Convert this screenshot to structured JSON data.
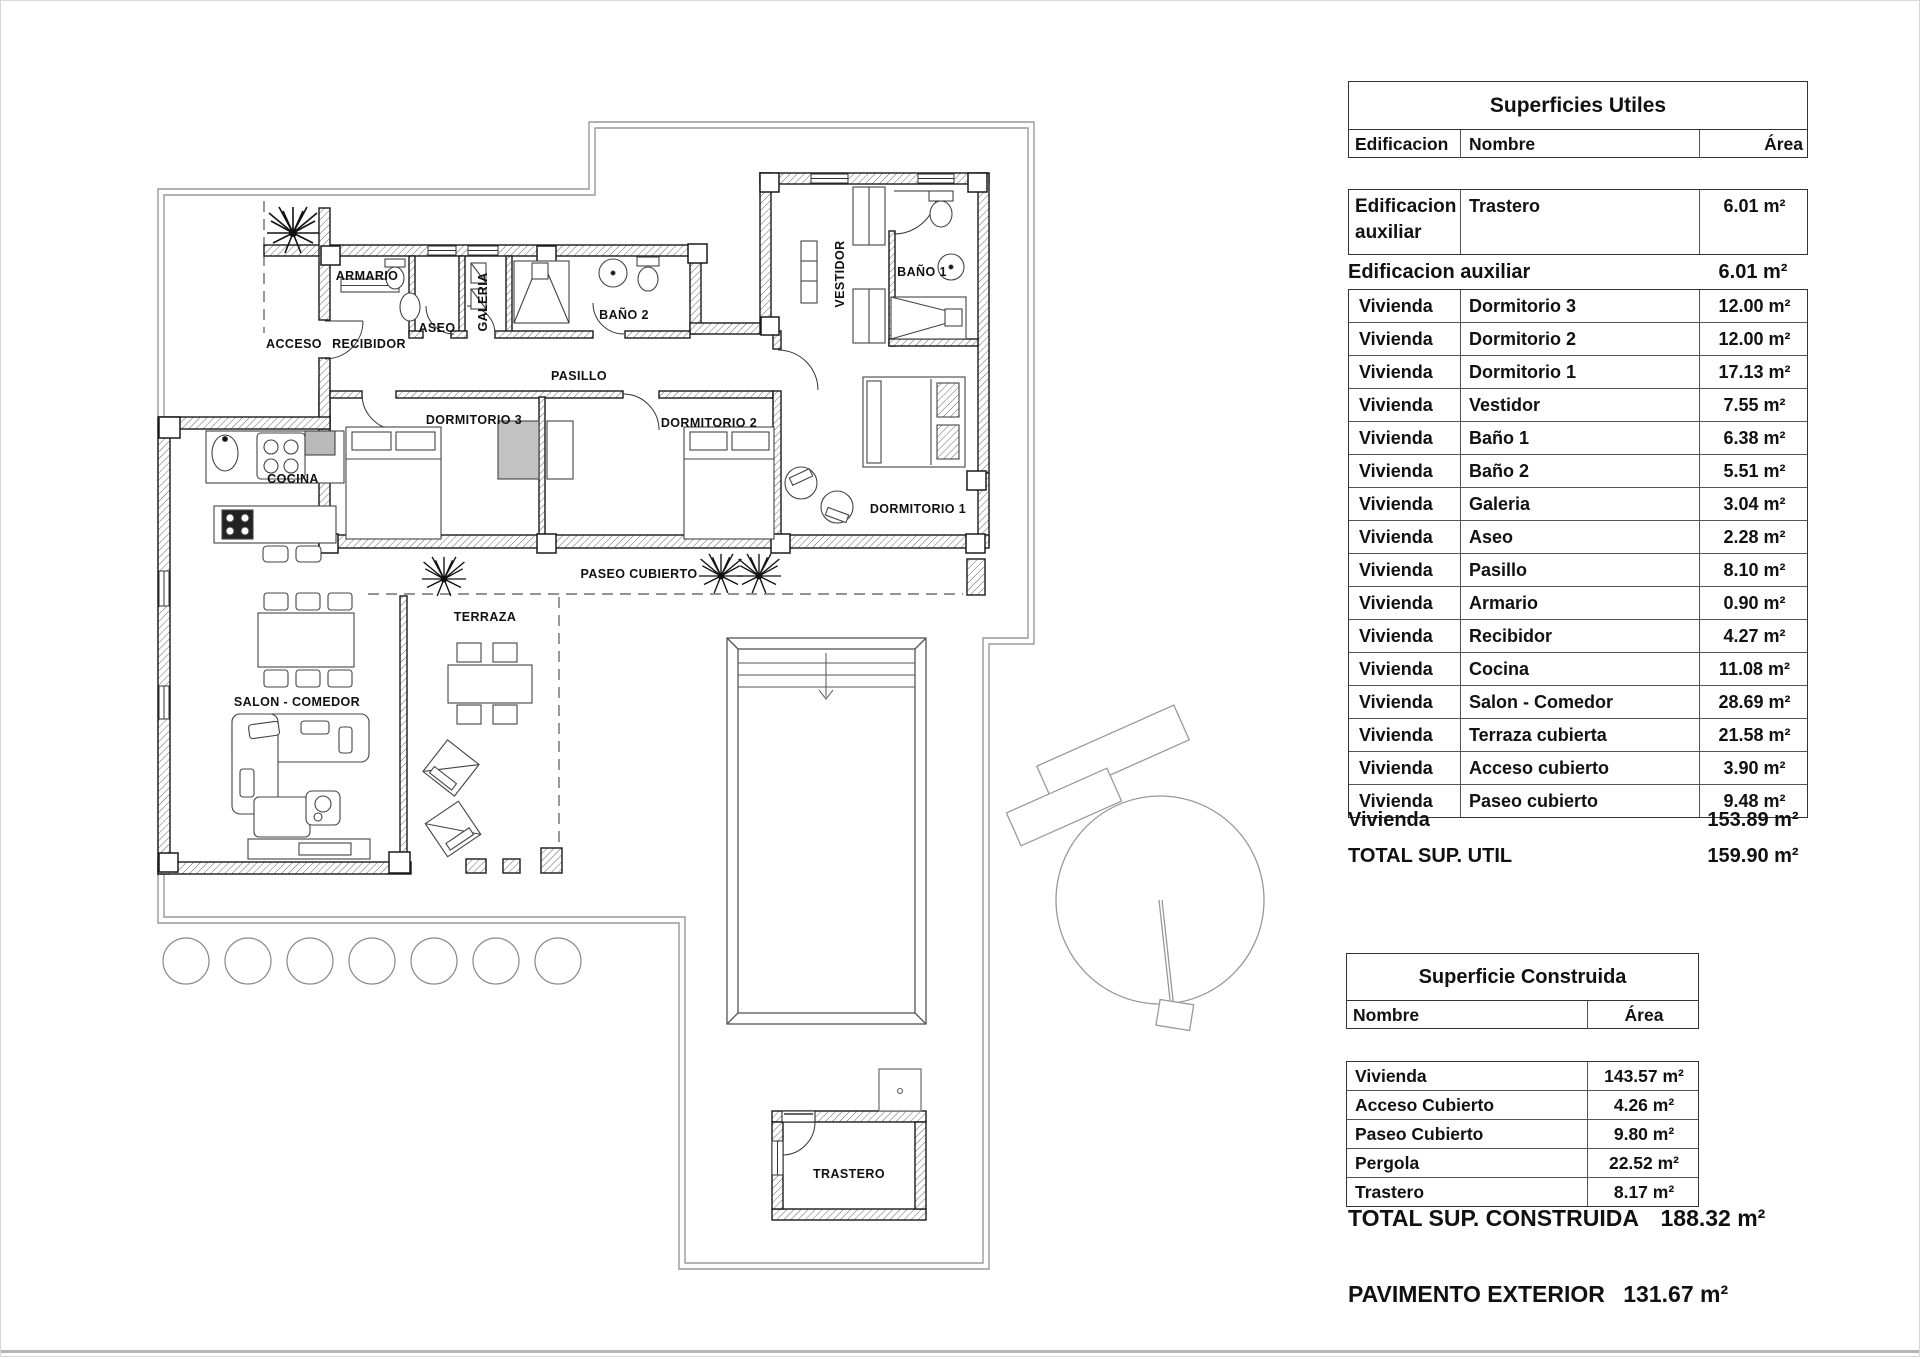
{
  "plan": {
    "labels": {
      "armario": "ARMARIO",
      "acceso": "ACCESO",
      "recibidor": "RECIBIDOR",
      "aseo": "ASEO",
      "galeria": "GALERIA",
      "bano2": "BAÑO 2",
      "pasillo": "PASILLO",
      "vestidor": "VESTIDOR",
      "bano1": "BAÑO 1",
      "dormitorio3": "DORMITORIO 3",
      "dormitorio2": "DORMITORIO 2",
      "dormitorio1": "DORMITORIO 1",
      "cocina": "COCINA",
      "paseo_cubierto": "PASEO CUBIERTO",
      "terraza": "TERRAZA",
      "salon_comedor": "SALON - COMEDOR",
      "trastero": "TRASTERO"
    }
  },
  "tables": {
    "superficies_utiles": {
      "title": "Superficies Utiles",
      "headers": {
        "edificacion": "Edificacion",
        "nombre": "Nombre",
        "area": "Área"
      },
      "aux_row": {
        "edificacion": "Edificacion auxiliar",
        "nombre": "Trastero",
        "area": "6.01 m²"
      },
      "aux_summary": {
        "label": "Edificacion auxiliar",
        "area": "6.01 m²"
      },
      "rows": [
        {
          "edificacion": "Vivienda",
          "nombre": "Dormitorio 3",
          "area": "12.00 m²"
        },
        {
          "edificacion": "Vivienda",
          "nombre": "Dormitorio 2",
          "area": "12.00 m²"
        },
        {
          "edificacion": "Vivienda",
          "nombre": "Dormitorio 1",
          "area": "17.13 m²"
        },
        {
          "edificacion": "Vivienda",
          "nombre": "Vestidor",
          "area": "7.55 m²"
        },
        {
          "edificacion": "Vivienda",
          "nombre": "Baño 1",
          "area": "6.38 m²"
        },
        {
          "edificacion": "Vivienda",
          "nombre": "Baño 2",
          "area": "5.51 m²"
        },
        {
          "edificacion": "Vivienda",
          "nombre": "Galeria",
          "area": "3.04 m²"
        },
        {
          "edificacion": "Vivienda",
          "nombre": "Aseo",
          "area": "2.28 m²"
        },
        {
          "edificacion": "Vivienda",
          "nombre": "Pasillo",
          "area": "8.10 m²"
        },
        {
          "edificacion": "Vivienda",
          "nombre": "Armario",
          "area": "0.90 m²"
        },
        {
          "edificacion": "Vivienda",
          "nombre": "Recibidor",
          "area": "4.27 m²"
        },
        {
          "edificacion": "Vivienda",
          "nombre": "Cocina",
          "area": "11.08 m²"
        },
        {
          "edificacion": "Vivienda",
          "nombre": "Salon - Comedor",
          "area": "28.69 m²"
        },
        {
          "edificacion": "Vivienda",
          "nombre": "Terraza cubierta",
          "area": "21.58 m²"
        },
        {
          "edificacion": "Vivienda",
          "nombre": "Acceso cubierto",
          "area": "3.90 m²"
        },
        {
          "edificacion": "Vivienda",
          "nombre": "Paseo cubierto",
          "area": "9.48 m²"
        }
      ],
      "vivienda_summary": {
        "label": "Vivienda",
        "area": "153.89 m²"
      },
      "total": {
        "label": "TOTAL SUP. UTIL",
        "area": "159.90 m²"
      }
    },
    "superficie_construida": {
      "title": "Superficie Construida",
      "headers": {
        "nombre": "Nombre",
        "area": "Área"
      },
      "rows": [
        {
          "nombre": "Vivienda",
          "area": "143.57 m²"
        },
        {
          "nombre": "Acceso Cubierto",
          "area": "4.26 m²"
        },
        {
          "nombre": "Paseo Cubierto",
          "area": "9.80 m²"
        },
        {
          "nombre": "Pergola",
          "area": "22.52 m²"
        },
        {
          "nombre": "Trastero",
          "area": "8.17 m²"
        }
      ],
      "total": {
        "label": "TOTAL SUP. CONSTRUIDA",
        "area": "188.32 m²"
      },
      "pavimento": {
        "label": "PAVIMENTO EXTERIOR",
        "area": "131.67 m²"
      }
    }
  }
}
